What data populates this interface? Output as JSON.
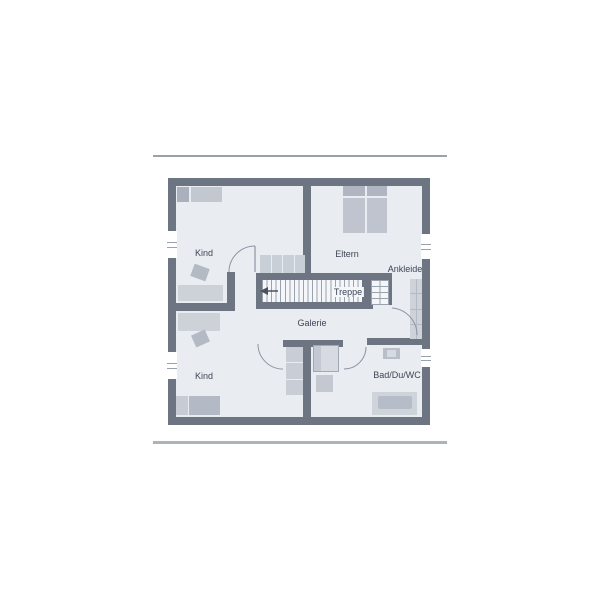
{
  "plan": {
    "type": "floor-plan",
    "rooms": {
      "kind_top": {
        "label": "Kind"
      },
      "eltern": {
        "label": "Eltern"
      },
      "ankleide": {
        "label": "Ankleide"
      },
      "treppe": {
        "label": "Treppe"
      },
      "galerie": {
        "label": "Galerie"
      },
      "kind_bottom": {
        "label": "Kind"
      },
      "bad": {
        "label": "Bad/Du/WC"
      }
    },
    "colors": {
      "wall": "#6d7582",
      "floor": "#e9edf2",
      "stair_tread_line": "#9aa2ad",
      "stair_tread_upper": "#c9cfd7",
      "furniture_light": "#cdd2d9",
      "furniture_medium": "#bfc4ce",
      "furniture_dark": "#aab1bc",
      "door_arc": "#8d95a3",
      "label_text": "#3d4554",
      "roof_line_top": "#99a1ab",
      "roof_line_bottom": "#adb3bb"
    }
  }
}
